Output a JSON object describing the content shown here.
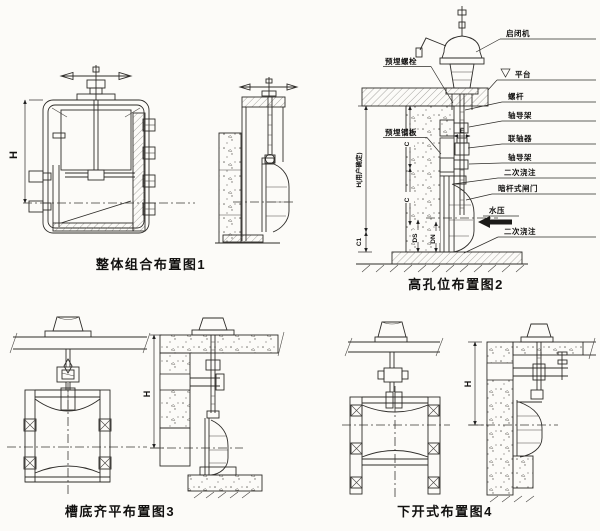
{
  "colors": {
    "background": "#fcfbf8",
    "line": "#2e2c29",
    "text": "#121110"
  },
  "figures": {
    "fig1": {
      "caption": "整体组合布置图1",
      "dim_h": "H"
    },
    "fig2": {
      "caption": "高孔位布置图2",
      "left_labels": [
        "预埋螺栓",
        "预埋钢板"
      ],
      "right_labels": [
        "启闭机",
        "平台",
        "螺杆",
        "轴导架",
        "联轴器",
        "轴导架",
        "二次浇注",
        "暗杆式闸门",
        "水压",
        "二次浇注"
      ],
      "dims": {
        "h": "H(用户确定)",
        "c": "C",
        "c1": "C1",
        "ds": "DS",
        "dn": "DN",
        "e": "E"
      }
    },
    "fig3": {
      "caption": "槽底齐平布置图3",
      "dim_h": "H"
    },
    "fig4": {
      "caption": "下开式布置图4",
      "dim_h": "H"
    }
  }
}
